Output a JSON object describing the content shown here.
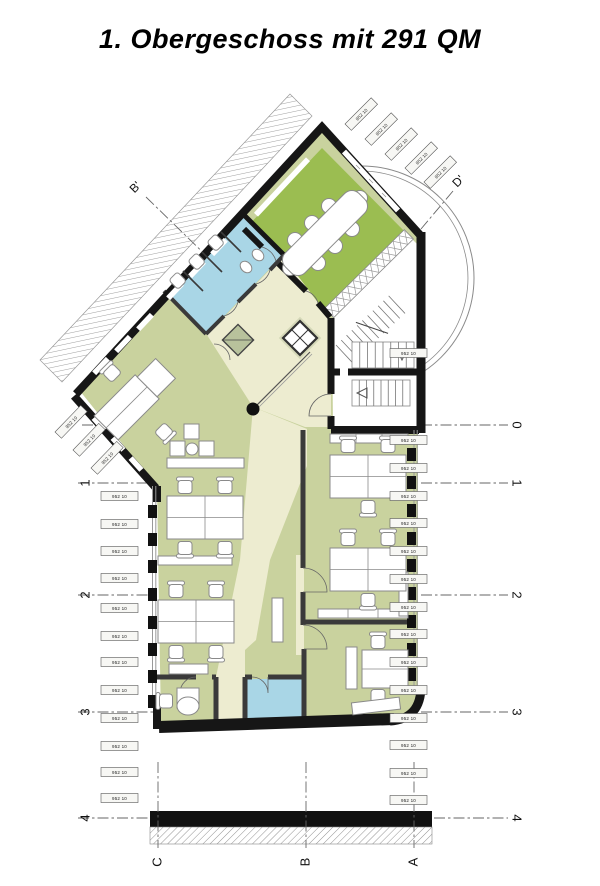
{
  "title": "1. Obergeschoss mit 291 QM",
  "grid": {
    "left_labels": [
      "1",
      "2",
      "3",
      "4"
    ],
    "right_labels": [
      "0",
      "1",
      "2",
      "3",
      "4"
    ],
    "bottom_labels": [
      "C",
      "B",
      "A"
    ],
    "section_markers": [
      "B'",
      "D'"
    ]
  },
  "window_tag_text": "952 10",
  "colors": {
    "meeting_room_green": "#9bbd51",
    "office_green": "#c9d29e",
    "sanitary_blue": "#a9d6e6",
    "circulation_cream": "#edecd0",
    "stairwell_white": "#ffffff",
    "wall_black": "#161616",
    "shaft_gray_green": "#b8c29c"
  },
  "rooms": [
    {
      "name": "meeting-room",
      "color_key": "meeting_room_green"
    },
    {
      "name": "sanitary-wc",
      "color_key": "sanitary_blue"
    },
    {
      "name": "open-office",
      "color_key": "office_green"
    },
    {
      "name": "office-right-upper",
      "color_key": "office_green"
    },
    {
      "name": "office-right-lower",
      "color_key": "office_green"
    },
    {
      "name": "meeting-booth",
      "color_key": "office_green"
    },
    {
      "name": "kitchen-room",
      "color_key": "sanitary_blue"
    },
    {
      "name": "corridor-lobby",
      "color_key": "circulation_cream"
    },
    {
      "name": "stairwell",
      "color_key": "stairwell_white"
    }
  ]
}
